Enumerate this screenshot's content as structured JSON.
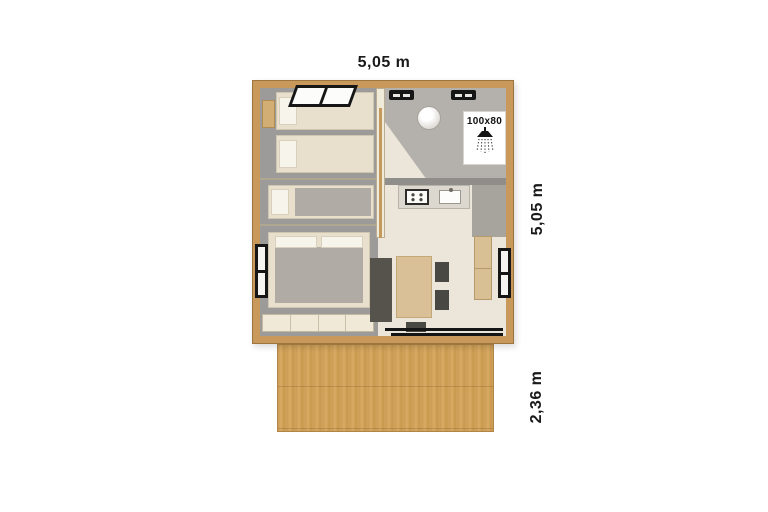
{
  "dimensions": {
    "width_label": "5,05 m",
    "depth_label": "5,05 m",
    "terrace_label": "2,36 m"
  },
  "bathroom": {
    "shower_label": "100x80",
    "shower_icon": "shower-head-icon"
  },
  "colors": {
    "frame_wood": "#c9995c",
    "deck_wood": "#d2a45e",
    "floor": "#ece6da",
    "bedroom_floor": "#9c9b99",
    "dark_furniture": "#56534d",
    "table_wood": "#d9c096",
    "label": "#1a1a1a"
  }
}
